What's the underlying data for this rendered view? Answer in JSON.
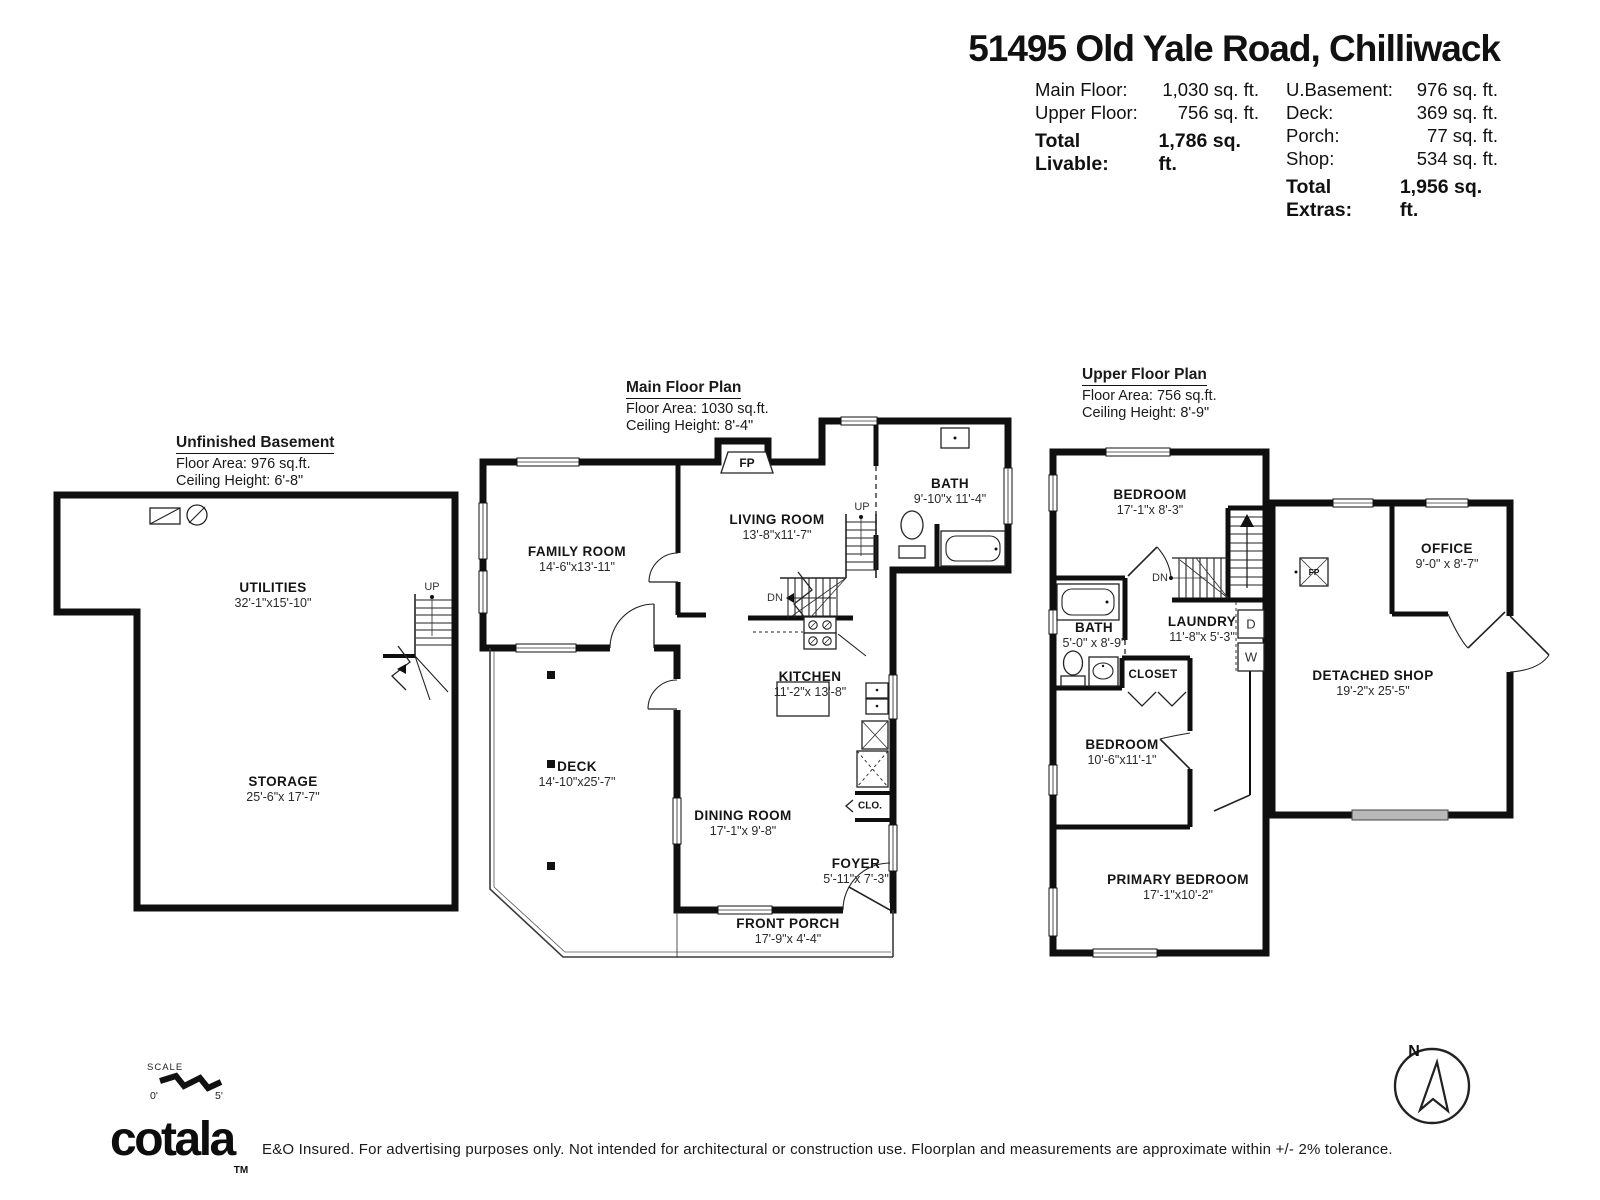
{
  "header": {
    "title": "51495 Old Yale Road, Chilliwack",
    "left_rows": [
      {
        "label": "Main Floor:",
        "value": "1,030 sq. ft."
      },
      {
        "label": "Upper Floor:",
        "value": "756 sq. ft."
      }
    ],
    "left_total_label": "Total Livable:",
    "left_total_value": "1,786 sq. ft.",
    "right_rows": [
      {
        "label": "U.Basement:",
        "value": "976 sq. ft."
      },
      {
        "label": "Deck:",
        "value": "369 sq. ft."
      },
      {
        "label": "Porch:",
        "value": "77 sq. ft."
      },
      {
        "label": "Shop:",
        "value": "534 sq. ft."
      }
    ],
    "right_total_label": "Total Extras:",
    "right_total_value": "1,956 sq. ft."
  },
  "plans": {
    "basement": {
      "title": "Unfinished Basement",
      "area": "Floor Area: 976 sq.ft.",
      "ceiling": "Ceiling Height: 6'-8\"",
      "rooms": [
        {
          "name": "UTILITIES",
          "dims": "32'-1\"x15'-10\""
        },
        {
          "name": "STORAGE",
          "dims": "25'-6\"x 17'-7\""
        }
      ],
      "labels": {
        "up": "UP"
      }
    },
    "main": {
      "title": "Main Floor Plan",
      "area": "Floor Area: 1030 sq.ft.",
      "ceiling": "Ceiling Height: 8'-4\"",
      "rooms": [
        {
          "name": "FAMILY ROOM",
          "dims": "14'-6\"x13'-11\""
        },
        {
          "name": "LIVING ROOM",
          "dims": "13'-8\"x11'-7\""
        },
        {
          "name": "BATH",
          "dims": "9'-10\"x 11'-4\""
        },
        {
          "name": "KITCHEN",
          "dims": "11'-2\"x 13'-8\""
        },
        {
          "name": "DECK",
          "dims": "14'-10\"x25'-7\""
        },
        {
          "name": "DINING ROOM",
          "dims": "17'-1\"x 9'-8\""
        },
        {
          "name": "FOYER",
          "dims": "5'-11\"x 7'-3\""
        },
        {
          "name": "FRONT PORCH",
          "dims": "17'-9\"x 4'-4\""
        }
      ],
      "labels": {
        "fp": "FP",
        "up": "UP",
        "dn": "DN",
        "closet": "CLO."
      }
    },
    "upper": {
      "title": "Upper Floor Plan",
      "area": "Floor Area: 756 sq.ft.",
      "ceiling": "Ceiling Height: 8'-9\"",
      "rooms": [
        {
          "name": "BEDROOM",
          "dims": "17'-1\"x 8'-3\""
        },
        {
          "name": "BATH",
          "dims": "5'-0\" x 8'-9\""
        },
        {
          "name": "LAUNDRY",
          "dims": "11'-8\"x 5'-3\""
        },
        {
          "name": "CLOSET",
          "dims": ""
        },
        {
          "name": "BEDROOM",
          "dims": "10'-6\"x11'-1\""
        },
        {
          "name": "PRIMARY BEDROOM",
          "dims": "17'-1\"x10'-2\""
        }
      ],
      "labels": {
        "dn": "DN",
        "dryer": "D",
        "washer": "W"
      }
    },
    "shop": {
      "rooms": [
        {
          "name": "OFFICE",
          "dims": "9'-0\" x 8'-7\""
        },
        {
          "name": "DETACHED SHOP",
          "dims": "19'-2\"x 25'-5\""
        }
      ],
      "labels": {
        "fp": "FP"
      }
    }
  },
  "footer": {
    "scale_label": "SCALE",
    "scale_zero": "0'",
    "scale_five": "5'",
    "brand": "cotala",
    "brand_tm": "TM",
    "disclaimer": "E&O Insured. For advertising purposes only. Not intended for architectural or construction use. Floorplan and measurements are approximate within +/- 2% tolerance.",
    "north": "N"
  }
}
